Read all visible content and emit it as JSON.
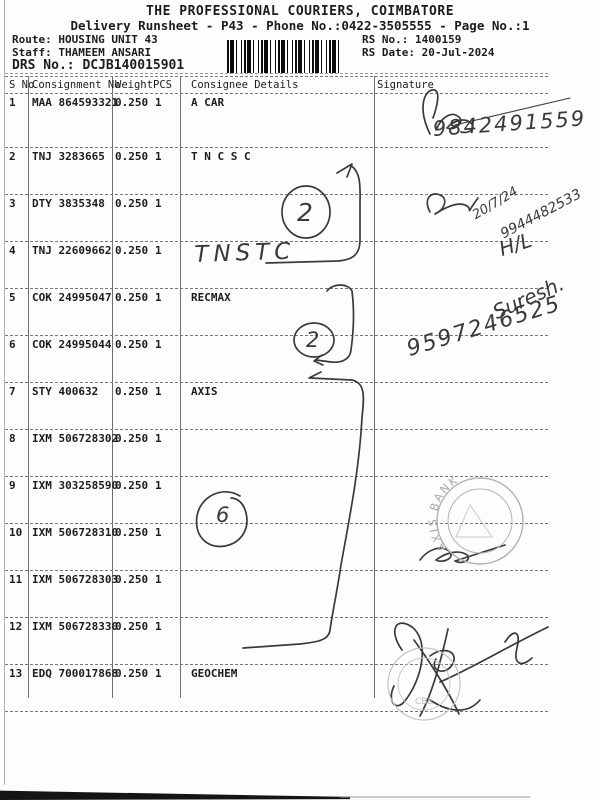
{
  "header": {
    "title": "THE PROFESSIONAL COURIERS, COIMBATORE",
    "subtitle": "Delivery Runsheet - P43 - Phone No.:0422-3505555 - Page No.:1",
    "route_label": "Route: ",
    "route": "HOUSING UNIT 43",
    "staff_label": "Staff: ",
    "staff": "THAMEEM ANSARI",
    "drs_label": "DRS No.: ",
    "drs_no": "DCJB140015901",
    "rs_no_label": "RS No.: ",
    "rs_no": "1400159",
    "rs_date_label": "RS Date: ",
    "rs_date": "20-Jul-2024"
  },
  "table": {
    "columns": [
      "S No",
      "Consignment No",
      "Weight",
      "PCS",
      "Consignee Details",
      "Signature"
    ],
    "rows": [
      {
        "s_no": "1",
        "consignment_no": "MAA 864593321",
        "weight": "0.250",
        "pcs": "1",
        "consignee": "A CAR"
      },
      {
        "s_no": "2",
        "consignment_no": "TNJ 3283665",
        "weight": "0.250",
        "pcs": "1",
        "consignee": "T N C S C"
      },
      {
        "s_no": "3",
        "consignment_no": "DTY 3835348",
        "weight": "0.250",
        "pcs": "1",
        "consignee": ""
      },
      {
        "s_no": "4",
        "consignment_no": "TNJ 22609662",
        "weight": "0.250",
        "pcs": "1",
        "consignee": ""
      },
      {
        "s_no": "5",
        "consignment_no": "COK 24995047",
        "weight": "0.250",
        "pcs": "1",
        "consignee": "RECMAX"
      },
      {
        "s_no": "6",
        "consignment_no": "COK 24995044",
        "weight": "0.250",
        "pcs": "1",
        "consignee": ""
      },
      {
        "s_no": "7",
        "consignment_no": "STY 400632",
        "weight": "0.250",
        "pcs": "1",
        "consignee": "AXIS"
      },
      {
        "s_no": "8",
        "consignment_no": "IXM 506728302",
        "weight": "0.250",
        "pcs": "1",
        "consignee": ""
      },
      {
        "s_no": "9",
        "consignment_no": "IXM 303258590",
        "weight": "0.250",
        "pcs": "1",
        "consignee": ""
      },
      {
        "s_no": "10",
        "consignment_no": "IXM 506728310",
        "weight": "0.250",
        "pcs": "1",
        "consignee": ""
      },
      {
        "s_no": "11",
        "consignment_no": "IXM 506728303",
        "weight": "0.250",
        "pcs": "1",
        "consignee": ""
      },
      {
        "s_no": "12",
        "consignment_no": "IXM 506728330",
        "weight": "0.250",
        "pcs": "1",
        "consignee": ""
      },
      {
        "s_no": "13",
        "consignment_no": "EDQ 700017868",
        "weight": "0.250",
        "pcs": "1",
        "consignee": "GEOCHEM"
      }
    ]
  },
  "handwriting": {
    "phone_row1": "9842491559",
    "date_row3": "20/7/24",
    "phone_row3": "9944482533",
    "consignee_row4": "TNSTC",
    "note_row4": "H/L",
    "name_row5": "Suresh.",
    "phone_row6": "9597246525",
    "circled_count_a": "2",
    "circled_count_b": "2",
    "circled_count_c": "6"
  },
  "stamps": {
    "axis_stamp_text": "AXIS BANK",
    "bottom_stamp_text": "CBE"
  },
  "colors": {
    "paper": "#fdfdfc",
    "print_ink": "#1c1c1c",
    "pen_ink": "#39393b",
    "stamp_ink": "#b3b0bc"
  }
}
